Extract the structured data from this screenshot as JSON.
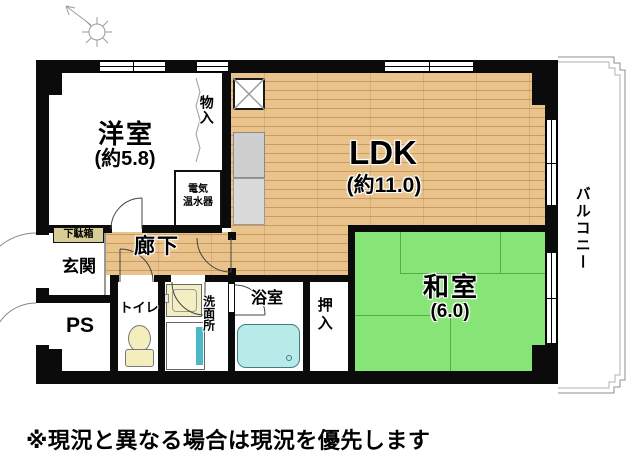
{
  "floorplan": {
    "rooms": {
      "western_room": {
        "label": "洋室",
        "area": "(約5.8)"
      },
      "ldk": {
        "label": "LDK",
        "area": "(約11.0)"
      },
      "japanese_room": {
        "label": "和室",
        "area": "(6.0)"
      },
      "balcony": {
        "label": "バルコニー"
      },
      "entrance": {
        "label": "玄関"
      },
      "hallway": {
        "label": "廊下"
      },
      "pipe_space": {
        "label": "PS"
      },
      "toilet": {
        "label": "トイレ"
      },
      "washroom": {
        "label": "洗面所"
      },
      "bathroom": {
        "label": "浴室"
      },
      "oshiire_closet": {
        "label": "押入"
      },
      "storage": {
        "label": "物入"
      },
      "shoe_cabinet": {
        "label": "下駄箱"
      },
      "water_heater": {
        "lines": [
          "電気",
          "温水器"
        ]
      }
    },
    "note": "※現況と異なる場合は現況を優先します",
    "colors": {
      "wall": "#0b0b0b",
      "wood_floor": "#eac28c",
      "tatami": "#87e477",
      "bathtub": "#b9eaea",
      "fixture_yellow": "#f3eebb",
      "washer_accent": "#49b8c8",
      "railing_gray": "#999999"
    }
  }
}
